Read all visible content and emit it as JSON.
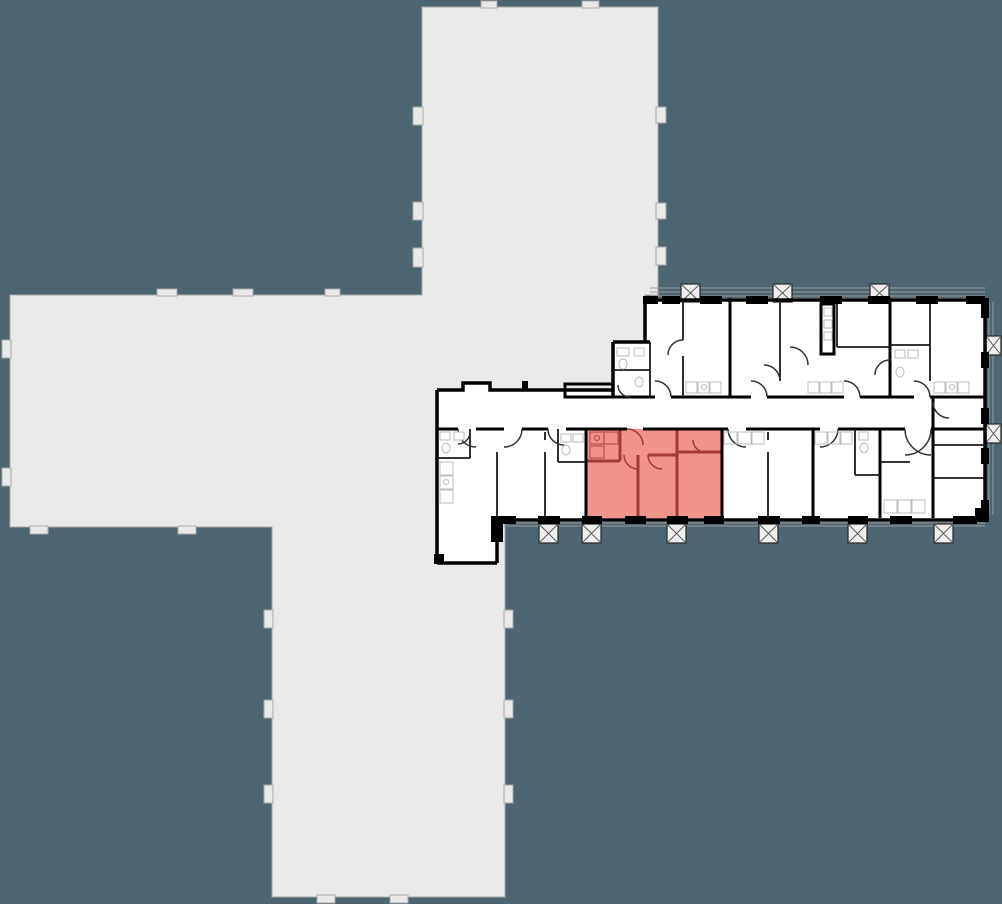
{
  "scene": {
    "type": "residential-floor-plan",
    "description": "Apartment-selection floor plan: cross-shaped silhouette of the adjacent tower section and a detailed residential wing with corridor, units, balconies, and one apartment highlighted in red",
    "highlighted_apartment": {
      "label": "highlighted-apartment",
      "rooms": 3,
      "position": "lower unit row, center-left",
      "color_key": "highlightFill"
    }
  },
  "colors": {
    "background": "#4D6570",
    "silhouette": "#E9E9E9",
    "silhouetteEdge": "#A9A9A9",
    "floor": "#FFFFFF",
    "wall": "#000000",
    "innerLine": "#1A1A1A",
    "fixture": "#BDBDBD",
    "rail": "#9A9A9A",
    "balconyFill": "#EFEFEF",
    "highlightFill": "#F2938B",
    "highlightWall": "#A33B31",
    "highlightLine": "#C4564B"
  },
  "balconies": {
    "top_x": [
      681,
      773,
      870
    ],
    "bottom_x": [
      539,
      582,
      667,
      759,
      848,
      934
    ],
    "right_y": [
      336,
      424
    ],
    "box_size": 19
  }
}
